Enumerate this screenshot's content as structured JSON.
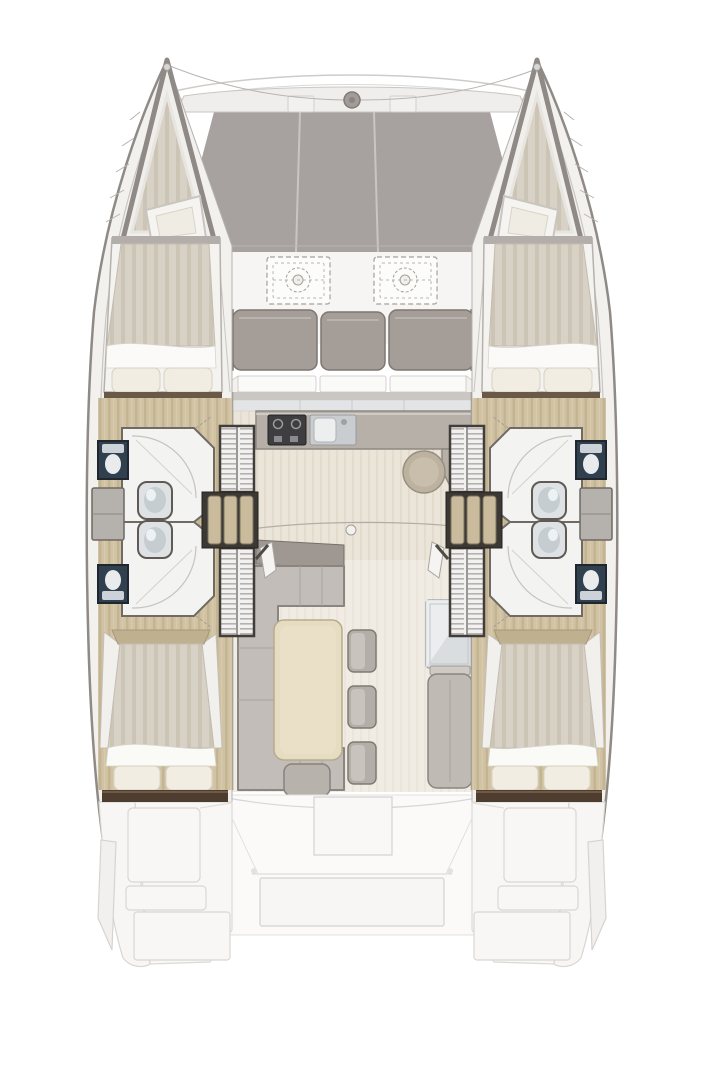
{
  "plan": {
    "vessel_type": "sailing catamaran floor plan",
    "hulls": 2,
    "forward_cabin_beds": 2,
    "aft_cabin_beds": 2,
    "shower_rooms": 4,
    "toilets": 4,
    "sinks": 4,
    "wardrobes": 4,
    "hull_staircases": 2,
    "forward_cockpit_tables": 2,
    "forward_bench_cushions": 3,
    "salon_dining_chairs": 3,
    "galley_features": [
      "stove",
      "double-sink",
      "round-sink",
      "fridge"
    ],
    "aft_area": "ghosted cockpit with bench and table"
  },
  "colors": {
    "background": "#ffffff",
    "hull_fill": "#f3f1ee",
    "hull_stroke": "#8f8a86",
    "deck_line": "#c9c5c1",
    "trampoline": "#a7a2a0",
    "tramp_seam": "#c9c5c3",
    "beam_fill": "#f0eeec",
    "windlass": "#a19c99",
    "cockpit_floor": "#f6f5f3",
    "wing_wall": "#e9e7e4",
    "cushion": "#a59d97",
    "cushion_dark": "#9d9590",
    "sill_white": "#fafaf9",
    "bulkhead": "#cac6c1",
    "window_band": "#e2e4e6",
    "counter": "#b7b0a9",
    "stove": "#3e3e41",
    "sink_steel": "#c9cdd0",
    "basin_white": "#edefef",
    "round_sink": "#bdb1a0",
    "round_sink_inner": "#c9bdab",
    "salon_base": "#ebe5d9",
    "salon_stripe": "#e3dccd",
    "wood_base": "#d0c2a2",
    "wood_stripe": "#c3b592",
    "mattress_base": "#d8d1c5",
    "mattress_stripe": "#ccc4b4",
    "pillow": "#f1ede2",
    "sheet": "#fbfaf8",
    "headboard": "#bfb090",
    "shelf_brown": "#4e3d2e",
    "sofa": "#c2bdb8",
    "sofa_stroke": "#8a857f",
    "sideboard": "#9f9892",
    "table_cream": "#e6dcc1",
    "chair": "#b3aea8",
    "fridge": "#dadde0",
    "bench": "#bfbab4",
    "bath_floor": "#f3f3f1",
    "bath_stroke": "#6f6a64",
    "toilet_navy": "#31404f",
    "fixture": "#dee2e4",
    "basin_grey": "#c6cdd1",
    "storage": "#b5b1ac",
    "louver_base": "#f2f1f0",
    "louver_line": "#b4b2b0",
    "wardrobe_frame": "#413d39",
    "stair_dark": "#3c3934",
    "stair_tread": "#c9bb9c",
    "ghost_fill": "#f8f7f6",
    "ghost_stroke": "#d8d6d3",
    "door_leaf": "#f5f4f2",
    "hinge": "#4e4a45"
  }
}
